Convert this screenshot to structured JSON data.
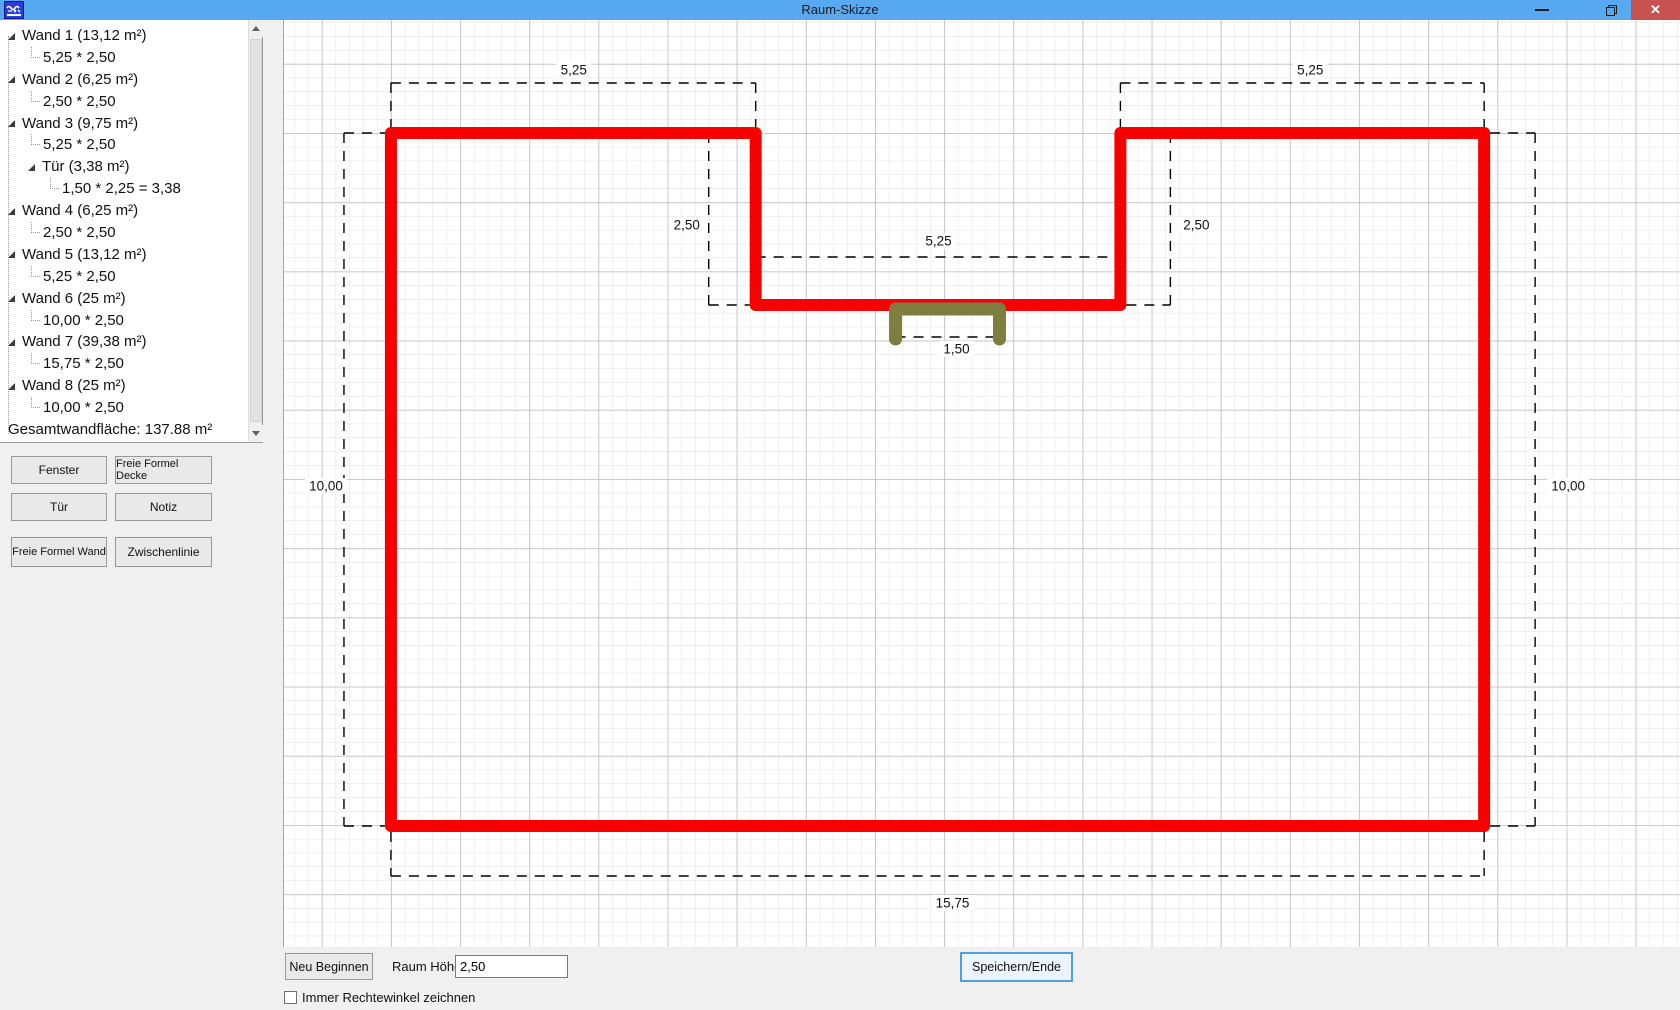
{
  "window": {
    "title": "Raum-Skizze",
    "titlebar_color": "#57a9f2",
    "close_color": "#c75050",
    "controls": {
      "minimize": "minimize",
      "restore": "restore",
      "close": "✕"
    }
  },
  "tree": {
    "items": [
      {
        "label": "Wand 1 (13,12 m²)",
        "depth": 0,
        "expander": true
      },
      {
        "label": "5,25 * 2,50",
        "depth": 1,
        "expander": false
      },
      {
        "label": "Wand 2 (6,25 m²)",
        "depth": 0,
        "expander": true
      },
      {
        "label": "2,50 * 2,50",
        "depth": 1,
        "expander": false
      },
      {
        "label": "Wand 3 (9,75 m²)",
        "depth": 0,
        "expander": true
      },
      {
        "label": "5,25 * 2,50",
        "depth": 1,
        "expander": false
      },
      {
        "label": "Tür (3,38 m²)",
        "depth": 1,
        "expander": true
      },
      {
        "label": "1,50 * 2,25 = 3,38",
        "depth": 2,
        "expander": false
      },
      {
        "label": "Wand 4 (6,25 m²)",
        "depth": 0,
        "expander": true
      },
      {
        "label": "2,50 * 2,50",
        "depth": 1,
        "expander": false
      },
      {
        "label": "Wand 5 (13,12 m²)",
        "depth": 0,
        "expander": true
      },
      {
        "label": "5,25 * 2,50",
        "depth": 1,
        "expander": false
      },
      {
        "label": "Wand 6 (25 m²)",
        "depth": 0,
        "expander": true
      },
      {
        "label": "10,00 * 2,50",
        "depth": 1,
        "expander": false
      },
      {
        "label": "Wand 7 (39,38 m²)",
        "depth": 0,
        "expander": true
      },
      {
        "label": "15,75 * 2,50",
        "depth": 1,
        "expander": false
      },
      {
        "label": "Wand 8 (25 m²)",
        "depth": 0,
        "expander": true
      },
      {
        "label": "10,00 * 2,50",
        "depth": 1,
        "expander": false
      },
      {
        "label": "Gesamtwandfläche: 137.88 m²",
        "depth": 0,
        "expander": false
      }
    ]
  },
  "sidebar_buttons": [
    {
      "label": "Fenster"
    },
    {
      "label": "Freie Formel Decke"
    },
    {
      "label": "Tür"
    },
    {
      "label": "Notiz"
    },
    {
      "label": "Freie Formel Wand"
    },
    {
      "label": "Zwischenlinie"
    }
  ],
  "bottom_bar": {
    "neu_beginnen": "Neu Beginnen",
    "raum_hoehe_label": "Raum Höhe",
    "raum_hoehe_value": "2,50",
    "speichern_ende": "Speichern/Ende",
    "checkbox_label": "Immer Rechtewinkel zeichnen",
    "checkbox_checked": false
  },
  "canvas": {
    "grid": {
      "minor_spacing": 13.84,
      "major_spacing": 69.2,
      "origin_x": 390,
      "origin_y": 133,
      "minor_color": "#e1e1e1",
      "major_color": "#c2c2c2",
      "background": "#ffffff"
    },
    "room": {
      "wall_color": "#f70000",
      "wall_thickness": 12,
      "outline_px": [
        [
          390,
          133
        ],
        [
          755,
          133
        ],
        [
          755,
          305
        ],
        [
          1120,
          305
        ],
        [
          1120,
          133
        ],
        [
          1484,
          133
        ],
        [
          1484,
          826
        ],
        [
          390,
          826
        ]
      ]
    },
    "door": {
      "color": "#7e7e3e",
      "thickness": 13,
      "points_px": [
        [
          895,
          339
        ],
        [
          895,
          309
        ],
        [
          999,
          309
        ],
        [
          999,
          339
        ]
      ]
    },
    "dash_color": "#000000",
    "dimensions": [
      {
        "id": "wand1-dim",
        "label": "5,25",
        "label_x": 573,
        "label_y": 70,
        "lines": [
          [
            390,
            83,
            755,
            83
          ],
          [
            390,
            83,
            390,
            129
          ],
          [
            755,
            83,
            755,
            129
          ]
        ]
      },
      {
        "id": "wand2-dim",
        "label": "2,50",
        "label_x": 686,
        "label_y": 225,
        "lines": [
          [
            708,
            133,
            708,
            305
          ],
          [
            708,
            133,
            749,
            133
          ],
          [
            708,
            305,
            749,
            305
          ]
        ]
      },
      {
        "id": "wand3-dim",
        "label": "5,25",
        "label_x": 938,
        "label_y": 241,
        "lines": [
          [
            755,
            257,
            1120,
            257
          ],
          [
            755,
            257,
            755,
            299
          ],
          [
            1120,
            257,
            1120,
            299
          ]
        ]
      },
      {
        "id": "wand4-dim",
        "label": "2,50",
        "label_x": 1196,
        "label_y": 225,
        "lines": [
          [
            1170,
            133,
            1170,
            305
          ],
          [
            1126,
            133,
            1170,
            133
          ],
          [
            1126,
            305,
            1170,
            305
          ]
        ]
      },
      {
        "id": "wand5-dim",
        "label": "5,25",
        "label_x": 1310,
        "label_y": 70,
        "lines": [
          [
            1120,
            83,
            1484,
            83
          ],
          [
            1120,
            83,
            1120,
            129
          ],
          [
            1484,
            83,
            1484,
            129
          ]
        ]
      },
      {
        "id": "wand6-dim",
        "label": "10,00",
        "label_x": 1568,
        "label_y": 486,
        "lines": [
          [
            1535,
            133,
            1535,
            826
          ],
          [
            1490,
            133,
            1535,
            133
          ],
          [
            1490,
            826,
            1535,
            826
          ]
        ]
      },
      {
        "id": "wand7-dim",
        "label": "15,75",
        "label_x": 952,
        "label_y": 903,
        "lines": [
          [
            390,
            876,
            1484,
            876
          ],
          [
            390,
            832,
            390,
            876
          ],
          [
            1484,
            832,
            1484,
            876
          ]
        ]
      },
      {
        "id": "wand8-dim",
        "label": "10,00",
        "label_x": 325,
        "label_y": 486,
        "lines": [
          [
            343,
            133,
            343,
            826
          ],
          [
            343,
            133,
            384,
            133
          ],
          [
            343,
            826,
            384,
            826
          ]
        ]
      },
      {
        "id": "tuer-dim",
        "label": "1,50",
        "label_x": 956,
        "label_y": 349,
        "lines": [
          [
            895,
            337,
            999,
            337
          ],
          [
            895,
            332,
            895,
            342
          ],
          [
            999,
            332,
            999,
            342
          ]
        ]
      }
    ]
  }
}
